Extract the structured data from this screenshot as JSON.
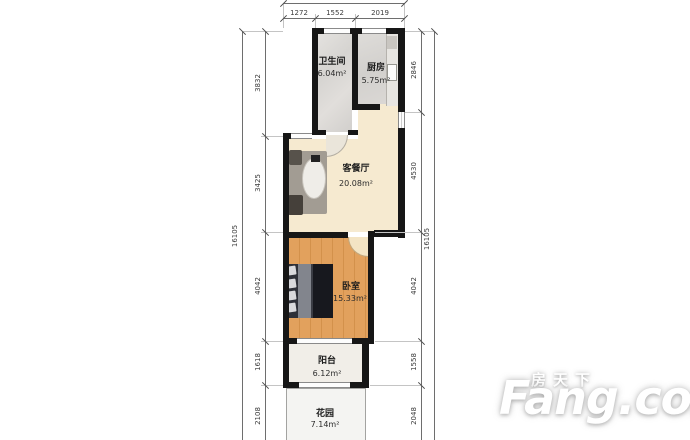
{
  "watermark": {
    "cn": "房天下",
    "en": "Fang.com"
  },
  "rooms": {
    "bathroom": {
      "name": "卫生间",
      "area": "6.04m²"
    },
    "kitchen": {
      "name": "厨房",
      "area": "5.75m²"
    },
    "living": {
      "name": "客餐厅",
      "area": "20.08m²"
    },
    "bedroom": {
      "name": "卧室",
      "area": "15.33m²"
    },
    "balcony": {
      "name": "阳台",
      "area": "6.12m²"
    },
    "garden": {
      "name": "花园",
      "area": "7.14m²"
    }
  },
  "dimensions": {
    "top": {
      "segments": [
        "1272",
        "1552",
        "2019"
      ]
    },
    "left": {
      "total": "16105",
      "segments": [
        "3832",
        "3425",
        "4042",
        "1618",
        "2108"
      ]
    },
    "right": {
      "total": "16105",
      "segments": [
        "2846",
        "4530",
        "4042",
        "1558",
        "2048"
      ]
    }
  },
  "colors": {
    "wall": "#161616",
    "living_floor": "#f6ead0",
    "bedroom_floor": "#e09c58",
    "bathroom_floor": "#dcdad7",
    "kitchen_floor": "#d8d6d3",
    "balcony_floor": "#f1eee8",
    "garden_floor": "#f4f4f2",
    "watermark": "#ffffff"
  }
}
